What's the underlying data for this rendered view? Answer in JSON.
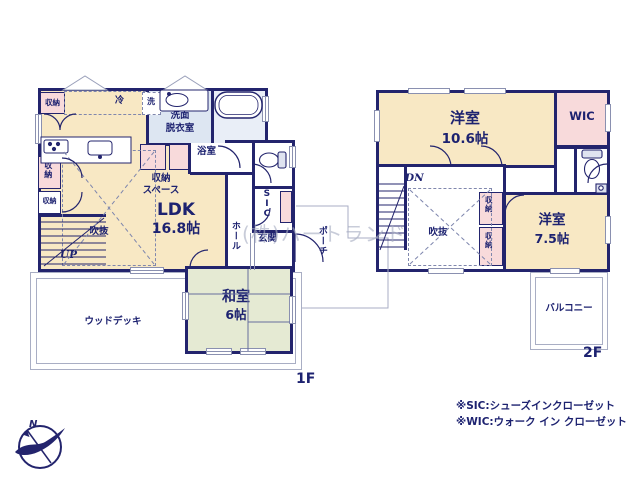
{
  "colors": {
    "wall": "#23246d",
    "ink": "#1d2270",
    "cream": "#f8e8c4",
    "pink": "#f8dadb",
    "wet": "#dde6f2",
    "bath": "#e9eef7",
    "tatami": "#e5ead3",
    "outline": "#a9aec4",
    "watermark": "#a8adc2"
  },
  "watermark": "(株)ハートランド",
  "compass": {
    "north": "N"
  },
  "floor1": {
    "label": "1F",
    "ldk": {
      "name": "LDK",
      "size": "16.8帖"
    },
    "washitsu": {
      "name": "和室",
      "size": "6帖"
    },
    "washroom": {
      "line1": "洗面",
      "line2": "脱衣室"
    },
    "bathroom": "浴室",
    "storage_space": {
      "line1": "収納",
      "line2": "スペース"
    },
    "void": "吹抜",
    "hall": "ホール",
    "sic": "SIC",
    "entrance": "玄関",
    "porch": "ポーチ",
    "wood_deck": "ウッドデッキ",
    "stairs": "UP",
    "fridge": "冷",
    "washer": "洗",
    "storage_kitchen": "収納",
    "storage_left_upper": "収納",
    "storage_left_lower": "収納"
  },
  "floor2": {
    "label": "2F",
    "bedroom_large": {
      "name": "洋室",
      "size": "10.6帖"
    },
    "bedroom_small": {
      "name": "洋室",
      "size": "7.5帖"
    },
    "wic": "WIC",
    "void": "吹抜",
    "balcony": "バルコニー",
    "stairs": "DN",
    "storage_upper": "収納",
    "storage_lower": "収納"
  },
  "legend": {
    "sic_note": "※SIC:シューズインクローゼット",
    "wic_note": "※WIC:ウォーク イン クローゼット"
  }
}
